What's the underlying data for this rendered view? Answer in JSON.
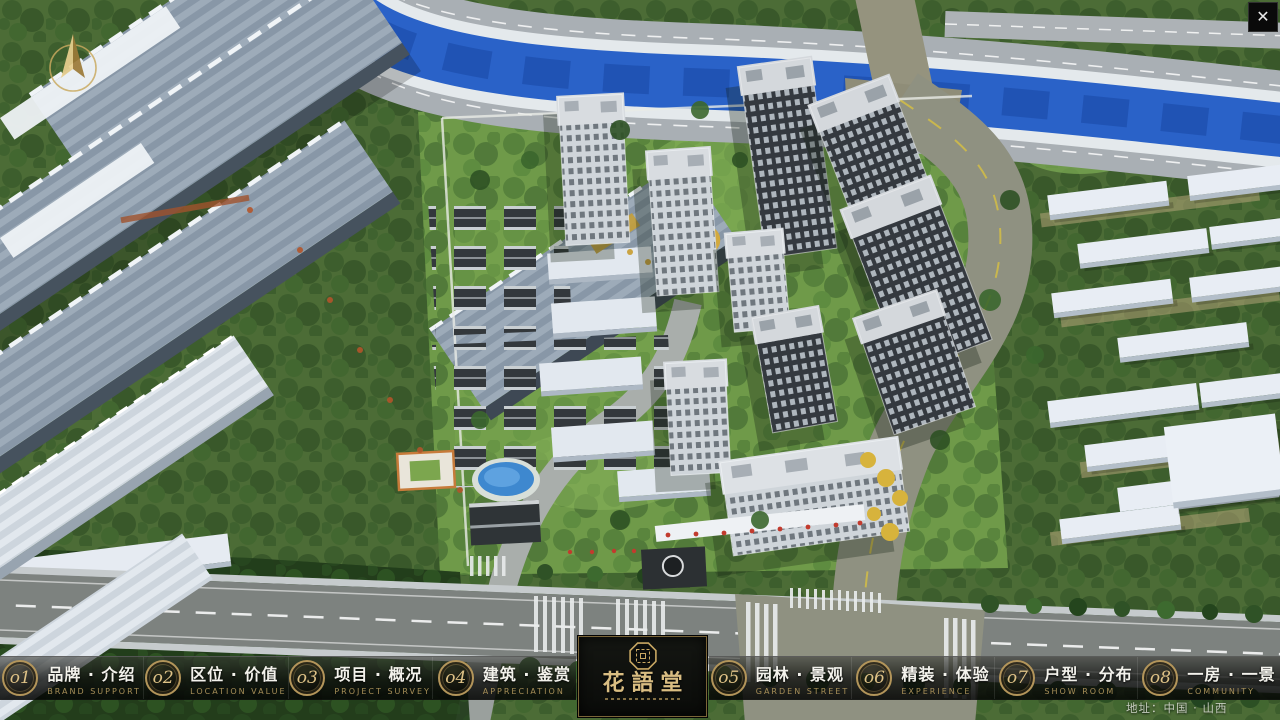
{
  "scene": {
    "address": "地址：中国 · 山西",
    "close_icon": "✕"
  },
  "navbar": {
    "items": [
      {
        "num": "o1",
        "label": "品牌 · 介绍",
        "sublabel": "BRAND SUPPORT"
      },
      {
        "num": "o2",
        "label": "区位 · 价值",
        "sublabel": "LOCATION VALUE"
      },
      {
        "num": "o3",
        "label": "项目 · 概况",
        "sublabel": "PROJECT SURVEY"
      },
      {
        "num": "o4",
        "label": "建筑 · 鉴赏",
        "sublabel": "APPRECIATION"
      },
      {
        "num": "o5",
        "label": "园林 · 景观",
        "sublabel": "GARDEN STREET"
      },
      {
        "num": "o6",
        "label": "精装 · 体验",
        "sublabel": "EXPERIENCE"
      },
      {
        "num": "o7",
        "label": "户型 · 分布",
        "sublabel": "SHOW ROOM"
      },
      {
        "num": "o8",
        "label": "一房 · 一景",
        "sublabel": "COMMUNITY"
      }
    ],
    "logo": {
      "title": "花語堂"
    }
  }
}
